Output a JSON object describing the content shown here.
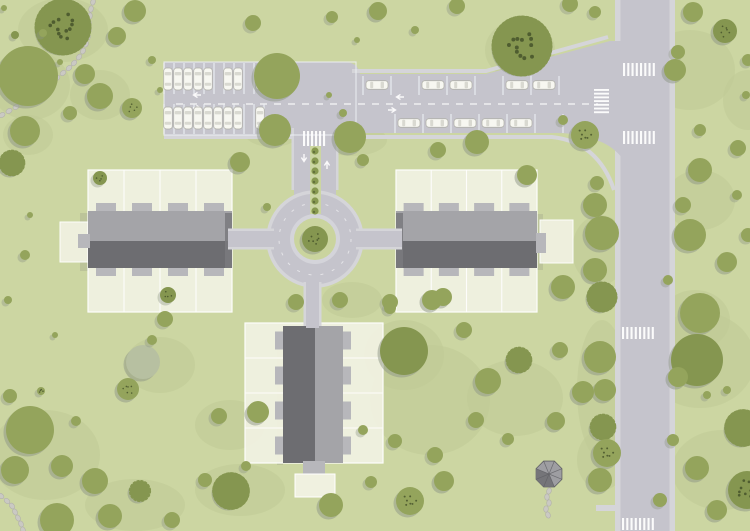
{
  "scene": {
    "type": "residential-site-plan",
    "description": "Top-down landscaped housing estate plan with three terraced buildings, a roundabout, parking areas and a vertical main road"
  },
  "palette": {
    "grass": "#ccd6a2",
    "patch": "#bfcb95",
    "plot": "#f0f1e0",
    "road": "#c5c4cc",
    "sidewalk": "#d5d5d9",
    "stall": "#eef0f4",
    "white": "#ffffff",
    "roofLight": "#a4a4a8",
    "roofDark": "#6d6d71",
    "gable": "#7a7a7e",
    "patio": "#b7b7bb",
    "carBody": "#f7f7f1",
    "carDetail": "#d9d9d1",
    "carOutline": "#aeaea6",
    "treeMain": "#94a45c",
    "treeDark": "#859650",
    "treeLight": "#a6b273",
    "treePale": "#b7c0a1",
    "treeShadow": "#8d9586",
    "speckle": "#3e4926",
    "bush": "#88994f",
    "islandRing": "#d4d4da",
    "islandGreen": "#cad49e",
    "stone": "#cac9c3",
    "stoneEdge": "#b2b1ab",
    "gazeboLight": "#9e9ea2",
    "gazeboDark": "#757579",
    "gazeboLine": "#606065",
    "shadow": "#5e5e66"
  },
  "features": {
    "roundabout": {
      "cx": 315,
      "cy": 239,
      "rOuter": 47,
      "rInner": 25,
      "rIsland": 21,
      "islandTree": [
        315,
        239,
        13,
        "dk"
      ]
    },
    "medianBushes": {
      "x": 315,
      "y0": 151,
      "step": 10,
      "count": 7,
      "stripX": 310,
      "stripY": 146,
      "stripW": 11,
      "stripH": 68
    },
    "crosswalks": [
      {
        "x": 303,
        "y": 131,
        "w": 24,
        "h": 15,
        "dir": "v"
      },
      {
        "x": 594,
        "y": 89,
        "w": 15,
        "h": 26,
        "dir": "h"
      },
      {
        "x": 623,
        "y": 63,
        "w": 34,
        "h": 13,
        "dir": "v"
      },
      {
        "x": 623,
        "y": 131,
        "w": 34,
        "h": 13,
        "dir": "v"
      },
      {
        "x": 622,
        "y": 327,
        "w": 34,
        "h": 12,
        "dir": "v"
      },
      {
        "x": 622,
        "y": 518,
        "w": 34,
        "h": 12,
        "dir": "v"
      }
    ],
    "laneDashes": {
      "x1": 176,
      "y1": 104,
      "x2": 598,
      "y2": 104
    },
    "ringDashes": {
      "cx": 315,
      "cy": 239,
      "r": 36
    },
    "arrows": [
      {
        "x": 193,
        "y": 95,
        "dir": "left"
      },
      {
        "x": 201,
        "y": 108,
        "dir": "right"
      },
      {
        "x": 396,
        "y": 97,
        "dir": "left"
      },
      {
        "x": 396,
        "y": 110,
        "dir": "right"
      },
      {
        "x": 304,
        "y": 162,
        "dir": "down"
      },
      {
        "x": 327,
        "y": 161,
        "dir": "up"
      }
    ],
    "stallLines": {
      "leftLot": {
        "x0": 164,
        "step": 10,
        "count": 11,
        "rows": [
          [
            63,
            94
          ],
          [
            104,
            134
          ]
        ],
        "outline": [
          164,
          62,
          192,
          73
        ]
      },
      "topRow": {
        "x0": 363,
        "step": 28,
        "count": 8,
        "y": [
          76,
          95
        ]
      },
      "bottomRow": {
        "x0": 395,
        "step": 28,
        "count": 7,
        "y": [
          114,
          133
        ]
      }
    },
    "cars": {
      "vertical": [
        {
          "y": 79,
          "x": [
            168,
            178,
            188,
            198,
            208,
            228,
            238,
            260
          ]
        },
        {
          "y": 118,
          "x": [
            168,
            178,
            188,
            198,
            208,
            218,
            228,
            238,
            260
          ]
        }
      ],
      "horizontal": [
        {
          "y": 85,
          "x": [
            377,
            433,
            461,
            517,
            544
          ]
        },
        {
          "y": 123,
          "x": [
            409,
            437,
            465,
            493,
            521
          ]
        }
      ]
    },
    "buildings": [
      {
        "id": "west-terrace",
        "dir": "h",
        "plot": [
          88,
          170,
          144,
          142
        ],
        "units": 4,
        "roofY": 211,
        "roofH": 57,
        "gable": [
          225,
          213,
          7,
          55
        ],
        "sidePlot": [
          60,
          222,
          28,
          40
        ],
        "stub": [
          78,
          234,
          12,
          14
        ],
        "shadow": [
          80,
          213,
          8,
          58
        ]
      },
      {
        "id": "east-terrace",
        "dir": "h",
        "plot": [
          396,
          170,
          141,
          142
        ],
        "units": 4,
        "roofY": 211,
        "roofH": 57,
        "gable": [
          396,
          213,
          7,
          55
        ],
        "sidePlot": [
          540,
          220,
          33,
          43
        ],
        "stub": null,
        "shadow": [
          537,
          214,
          6,
          56
        ]
      },
      {
        "id": "south-terrace",
        "dir": "v",
        "plot": [
          245,
          323,
          138,
          140
        ],
        "units": 4,
        "roofX": 283,
        "roofW": 60,
        "bottomPatio": [
          303,
          461,
          22,
          13
        ],
        "bottomPlot": [
          295,
          474,
          40,
          23
        ],
        "shadow": [
          277,
          330,
          6,
          135
        ]
      }
    ],
    "gazebo": {
      "cx": 549,
      "cy": 474,
      "r": 14
    },
    "stonePaths": [
      [
        [
          93,
          2
        ],
        [
          91,
          9
        ],
        [
          90,
          16
        ],
        [
          89,
          23
        ],
        [
          89,
          30
        ],
        [
          88,
          37
        ],
        [
          86,
          44
        ],
        [
          83,
          51
        ],
        [
          79,
          57
        ],
        [
          74,
          63
        ],
        [
          69,
          68
        ],
        [
          63,
          73
        ],
        [
          57,
          78
        ],
        [
          51,
          83
        ],
        [
          44,
          88
        ],
        [
          37,
          93
        ],
        [
          30,
          98
        ],
        [
          23,
          103
        ],
        [
          16,
          107
        ],
        [
          9,
          111
        ],
        [
          2,
          115
        ]
      ],
      [
        [
          1,
          496
        ],
        [
          7,
          501
        ],
        [
          12,
          506
        ],
        [
          15,
          512
        ],
        [
          18,
          518
        ],
        [
          21,
          524
        ],
        [
          23,
          530
        ]
      ],
      [
        [
          549,
          491
        ],
        [
          547,
          497
        ],
        [
          549,
          503
        ],
        [
          546,
          509
        ],
        [
          548,
          515
        ]
      ]
    ],
    "patches": [
      [
        63,
        30,
        45,
        32
      ],
      [
        30,
        85,
        40,
        35
      ],
      [
        100,
        95,
        30,
        25
      ],
      [
        28,
        135,
        25,
        20
      ],
      [
        690,
        70,
        45,
        40
      ],
      [
        748,
        100,
        25,
        30
      ],
      [
        520,
        50,
        35,
        30
      ],
      [
        700,
        200,
        35,
        30
      ],
      [
        600,
        250,
        28,
        35
      ],
      [
        695,
        320,
        35,
        30
      ],
      [
        700,
        360,
        55,
        48
      ],
      [
        722,
        470,
        50,
        40
      ],
      [
        602,
        390,
        25,
        70
      ],
      [
        602,
        460,
        25,
        30
      ],
      [
        45,
        455,
        55,
        45
      ],
      [
        135,
        505,
        50,
        26
      ],
      [
        240,
        490,
        45,
        26
      ],
      [
        230,
        425,
        35,
        25
      ],
      [
        430,
        400,
        60,
        55
      ],
      [
        515,
        398,
        48,
        38
      ],
      [
        404,
        355,
        40,
        35
      ],
      [
        352,
        300,
        30,
        18
      ],
      [
        160,
        365,
        35,
        28
      ],
      [
        352,
        140,
        35,
        16
      ],
      [
        272,
        132,
        28,
        15
      ]
    ],
    "trees": [
      [
        63,
        27,
        26,
        "dsk"
      ],
      [
        28,
        76,
        30,
        "p"
      ],
      [
        135,
        11,
        11,
        "p"
      ],
      [
        117,
        36,
        9,
        "p"
      ],
      [
        85,
        74,
        10,
        "p"
      ],
      [
        100,
        96,
        13,
        "p"
      ],
      [
        132,
        108,
        10,
        "pk"
      ],
      [
        70,
        113,
        7,
        "p"
      ],
      [
        25,
        131,
        15,
        "p"
      ],
      [
        12,
        163,
        12,
        "ds"
      ],
      [
        43,
        33,
        4,
        "p"
      ],
      [
        15,
        35,
        4,
        "d"
      ],
      [
        60,
        62,
        3,
        "p"
      ],
      [
        4,
        8,
        3,
        "p"
      ],
      [
        152,
        60,
        4,
        "p"
      ],
      [
        160,
        90,
        3,
        "p"
      ],
      [
        25,
        255,
        5,
        "p"
      ],
      [
        30,
        215,
        3,
        "p"
      ],
      [
        8,
        300,
        4,
        "p"
      ],
      [
        55,
        335,
        3,
        "p"
      ],
      [
        253,
        23,
        8,
        "p"
      ],
      [
        332,
        17,
        6,
        "p"
      ],
      [
        283,
        62,
        7,
        "p"
      ],
      [
        378,
        11,
        9,
        "p"
      ],
      [
        457,
        6,
        8,
        "p"
      ],
      [
        415,
        30,
        4,
        "p"
      ],
      [
        357,
        40,
        3,
        "p"
      ],
      [
        277,
        76,
        23,
        "p"
      ],
      [
        522,
        46,
        28,
        "dsk"
      ],
      [
        570,
        4,
        8,
        "p"
      ],
      [
        595,
        12,
        6,
        "p"
      ],
      [
        678,
        52,
        7,
        "p"
      ],
      [
        675,
        70,
        11,
        "p"
      ],
      [
        693,
        12,
        10,
        "p"
      ],
      [
        725,
        31,
        12,
        "dk"
      ],
      [
        748,
        60,
        6,
        "p"
      ],
      [
        746,
        95,
        4,
        "p"
      ],
      [
        585,
        135,
        14,
        "pk"
      ],
      [
        563,
        120,
        5,
        "p"
      ],
      [
        700,
        130,
        6,
        "p"
      ],
      [
        738,
        148,
        8,
        "p"
      ],
      [
        700,
        170,
        12,
        "p"
      ],
      [
        683,
        205,
        8,
        "p"
      ],
      [
        737,
        195,
        5,
        "p"
      ],
      [
        690,
        235,
        16,
        "p"
      ],
      [
        727,
        262,
        10,
        "p"
      ],
      [
        748,
        235,
        7,
        "p"
      ],
      [
        668,
        280,
        5,
        "p"
      ],
      [
        700,
        313,
        20,
        "p"
      ],
      [
        697,
        360,
        26,
        "d"
      ],
      [
        678,
        377,
        10,
        "p"
      ],
      [
        727,
        390,
        4,
        "p"
      ],
      [
        707,
        395,
        4,
        "p"
      ],
      [
        743,
        428,
        17,
        "ds"
      ],
      [
        747,
        490,
        19,
        "dk"
      ],
      [
        697,
        468,
        12,
        "p"
      ],
      [
        717,
        510,
        10,
        "p"
      ],
      [
        673,
        440,
        6,
        "p"
      ],
      [
        660,
        500,
        7,
        "p"
      ],
      [
        597,
        183,
        7,
        "p"
      ],
      [
        595,
        205,
        12,
        "p"
      ],
      [
        602,
        233,
        17,
        "p"
      ],
      [
        595,
        270,
        12,
        "p"
      ],
      [
        602,
        297,
        14,
        "ds"
      ],
      [
        600,
        357,
        16,
        "p"
      ],
      [
        605,
        390,
        11,
        "p"
      ],
      [
        603,
        427,
        12,
        "ds"
      ],
      [
        607,
        453,
        14,
        "pk"
      ],
      [
        600,
        480,
        12,
        "p"
      ],
      [
        563,
        287,
        12,
        "p"
      ],
      [
        560,
        350,
        8,
        "p"
      ],
      [
        583,
        392,
        11,
        "p"
      ],
      [
        556,
        421,
        9,
        "p"
      ],
      [
        240,
        162,
        10,
        "p"
      ],
      [
        275,
        130,
        16,
        "p"
      ],
      [
        350,
        137,
        16,
        "p"
      ],
      [
        363,
        160,
        6,
        "p"
      ],
      [
        438,
        150,
        8,
        "p"
      ],
      [
        477,
        142,
        12,
        "p"
      ],
      [
        267,
        207,
        4,
        "p"
      ],
      [
        343,
        113,
        4,
        "p"
      ],
      [
        329,
        95,
        3,
        "p"
      ],
      [
        100,
        178,
        7,
        "dk"
      ],
      [
        168,
        295,
        8,
        "dk"
      ],
      [
        527,
        175,
        10,
        "p"
      ],
      [
        443,
        297,
        9,
        "p"
      ],
      [
        390,
        302,
        8,
        "p"
      ],
      [
        404,
        351,
        24,
        "d"
      ],
      [
        435,
        455,
        8,
        "p"
      ],
      [
        296,
        302,
        8,
        "p"
      ],
      [
        340,
        300,
        8,
        "p"
      ],
      [
        390,
        308,
        6,
        "p"
      ],
      [
        432,
        300,
        10,
        "p"
      ],
      [
        464,
        330,
        8,
        "p"
      ],
      [
        488,
        381,
        13,
        "p"
      ],
      [
        519,
        360,
        12,
        "ds"
      ],
      [
        476,
        420,
        8,
        "p"
      ],
      [
        508,
        439,
        6,
        "p"
      ],
      [
        363,
        430,
        5,
        "p"
      ],
      [
        395,
        441,
        7,
        "p"
      ],
      [
        371,
        482,
        6,
        "p"
      ],
      [
        331,
        505,
        12,
        "p"
      ],
      [
        410,
        501,
        14,
        "pk"
      ],
      [
        444,
        481,
        10,
        "p"
      ],
      [
        258,
        412,
        11,
        "p"
      ],
      [
        219,
        416,
        8,
        "p"
      ],
      [
        231,
        491,
        17,
        "ds"
      ],
      [
        205,
        480,
        7,
        "p"
      ],
      [
        246,
        466,
        5,
        "p"
      ],
      [
        172,
        520,
        8,
        "p"
      ],
      [
        110,
        516,
        12,
        "p"
      ],
      [
        140,
        491,
        10,
        "ds"
      ],
      [
        95,
        481,
        13,
        "p"
      ],
      [
        57,
        520,
        17,
        "p"
      ],
      [
        30,
        430,
        24,
        "p"
      ],
      [
        15,
        470,
        14,
        "p"
      ],
      [
        62,
        466,
        11,
        "p"
      ],
      [
        10,
        396,
        7,
        "p"
      ],
      [
        76,
        421,
        5,
        "p"
      ],
      [
        41,
        391,
        4,
        "pk"
      ],
      [
        165,
        319,
        8,
        "p"
      ],
      [
        143,
        362,
        17,
        "a"
      ],
      [
        128,
        389,
        11,
        "pk"
      ],
      [
        152,
        340,
        5,
        "p"
      ]
    ]
  }
}
